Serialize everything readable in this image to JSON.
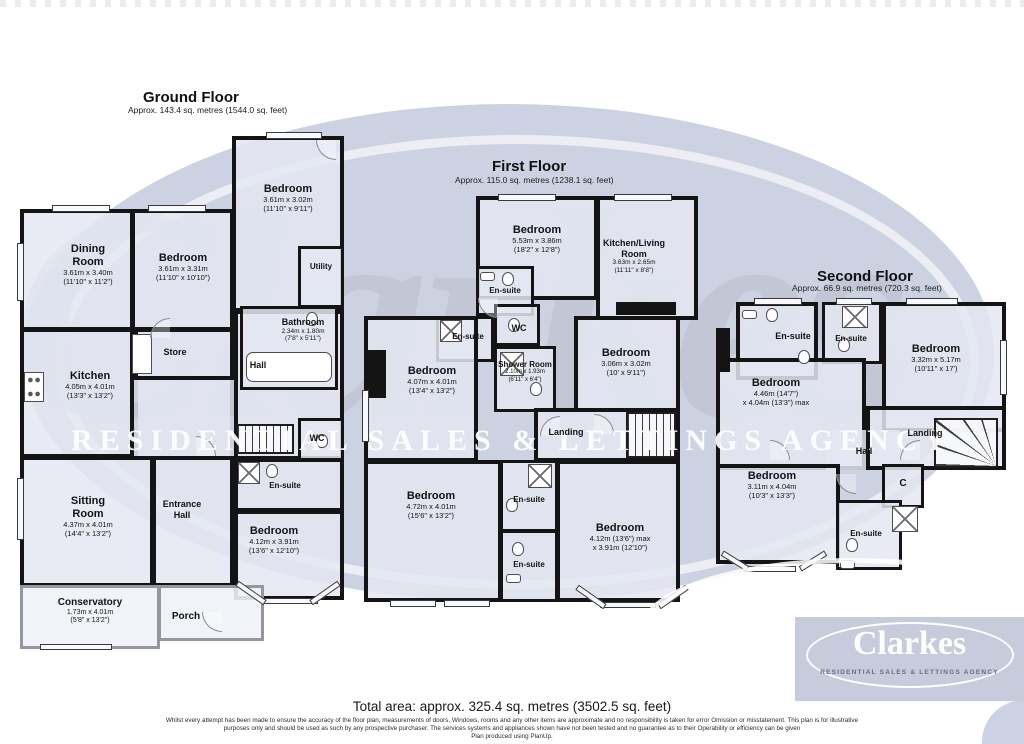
{
  "watermark": {
    "brand": "Clarkes",
    "tagline": "RESIDENTIAL SALES & LETTINGS AGENCY"
  },
  "logo": {
    "brand": "Clarkes",
    "tagline": "RESIDENTIAL SALES & LETTINGS AGENCY"
  },
  "footer": {
    "total_area": "Total area: approx. 325.4 sq. metres (3502.5 sq. feet)",
    "disclaimer1": "Whilst every attempt has been made to ensure the accuracy of the floor plan, measurements of doors, Windows, rooms and any other items are approximate and no responsibility is taken for error Omission or misstatement. This plan is for illustrative",
    "disclaimer2": "purposes only and should be used as such by any prospective purchaser. The services systems and appliances shown have not been tested and no guarantee as to their Operability or efficiency can be given",
    "disclaimer3": "Plan produced using PlanUp."
  },
  "floors": {
    "ground": {
      "title": "Ground Floor",
      "subtitle": "Approx. 143.4 sq. metres (1544.0 sq. feet)",
      "rooms": {
        "bedroom_top": {
          "name": "Bedroom",
          "metric": "3.61m x 3.02m",
          "imperial": "(11'10\" x 9'11\")"
        },
        "dining": {
          "name": "Dining Room",
          "metric": "3.61m x 3.40m",
          "imperial": "(11'10\" x 11'2\")"
        },
        "bedroom_mid": {
          "name": "Bedroom",
          "metric": "3.61m x 3.31m",
          "imperial": "(11'10\" x 10'10\")"
        },
        "utility": {
          "name": "Utility"
        },
        "bathroom": {
          "name": "Bathroom",
          "metric": "2.34m x 1.80m",
          "imperial": "(7'8\" x 5'11\")"
        },
        "store": {
          "name": "Store"
        },
        "hall": {
          "name": "Hall"
        },
        "kitchen": {
          "name": "Kitchen",
          "metric": "4.05m x 4.01m",
          "imperial": "(13'3\" x 13'2\")"
        },
        "wc": {
          "name": "WC"
        },
        "ensuite": {
          "name": "En-suite"
        },
        "sitting": {
          "name": "Sitting Room",
          "metric": "4.37m x 4.01m",
          "imperial": "(14'4\" x 13'2\")"
        },
        "entrance": {
          "name": "Entrance Hall"
        },
        "bedroom_bottom": {
          "name": "Bedroom",
          "metric": "4.12m x 3.91m",
          "imperial": "(13'6\" x 12'10\")"
        },
        "conservatory": {
          "name": "Conservatory",
          "metric": "1.73m x 4.01m",
          "imperial": "(5'8\" x 13'2\")"
        },
        "porch": {
          "name": "Porch"
        }
      }
    },
    "first": {
      "title": "First Floor",
      "subtitle": "Approx. 115.0 sq. metres (1238.1 sq. feet)",
      "rooms": {
        "bedroom_top": {
          "name": "Bedroom",
          "metric": "5.53m x 3.86m",
          "imperial": "(18'2\" x 12'8\")"
        },
        "kitchen_living": {
          "name": "Kitchen/Living Room",
          "metric": "3.63m x 2.65m",
          "imperial": "(11'11\" x 8'8\")"
        },
        "ensuite_top": {
          "name": "En-suite"
        },
        "wc": {
          "name": "WC"
        },
        "ensuite_left": {
          "name": "En-suite"
        },
        "bedroom_left": {
          "name": "Bedroom",
          "metric": "4.07m x 4.01m",
          "imperial": "(13'4\" x 13'2\")"
        },
        "shower": {
          "name": "Shower Room",
          "metric": "2.10m x 1.93m",
          "imperial": "(6'11\" x 6'4\")"
        },
        "bedroom_right": {
          "name": "Bedroom",
          "metric": "3.06m x 3.02m",
          "imperial": "(10' x 9'11\")"
        },
        "landing": {
          "name": "Landing"
        },
        "bedroom_bl": {
          "name": "Bedroom",
          "metric": "4.72m x 4.01m",
          "imperial": "(15'6\" x 13'2\")"
        },
        "ensuite_mid": {
          "name": "En-suite"
        },
        "ensuite_bottom": {
          "name": "En-suite"
        },
        "bedroom_br": {
          "name": "Bedroom",
          "metric": "4.12m (13'6\") max",
          "imperial": "x 3.91m (12'10\")"
        }
      }
    },
    "second": {
      "title": "Second Floor",
      "subtitle": "Approx. 66.9 sq. metres (720.3 sq. feet)",
      "rooms": {
        "ensuite_left": {
          "name": "En-suite"
        },
        "ensuite_right": {
          "name": "En-suite"
        },
        "bedroom_right": {
          "name": "Bedroom",
          "metric": "3.32m x 5.17m",
          "imperial": "(10'11\" x 17')"
        },
        "bedroom_left": {
          "name": "Bedroom",
          "metric": "4.46m (14'7\")",
          "imperial": "x 4.04m (13'3\") max"
        },
        "hall": {
          "name": "Hall"
        },
        "landing": {
          "name": "Landing"
        },
        "bedroom_bottom": {
          "name": "Bedroom",
          "metric": "3.11m x 4.04m",
          "imperial": "(10'3\" x 13'3\")"
        },
        "cupboard": {
          "name": "C"
        },
        "ensuite_bottom": {
          "name": "En-suite"
        }
      }
    }
  }
}
